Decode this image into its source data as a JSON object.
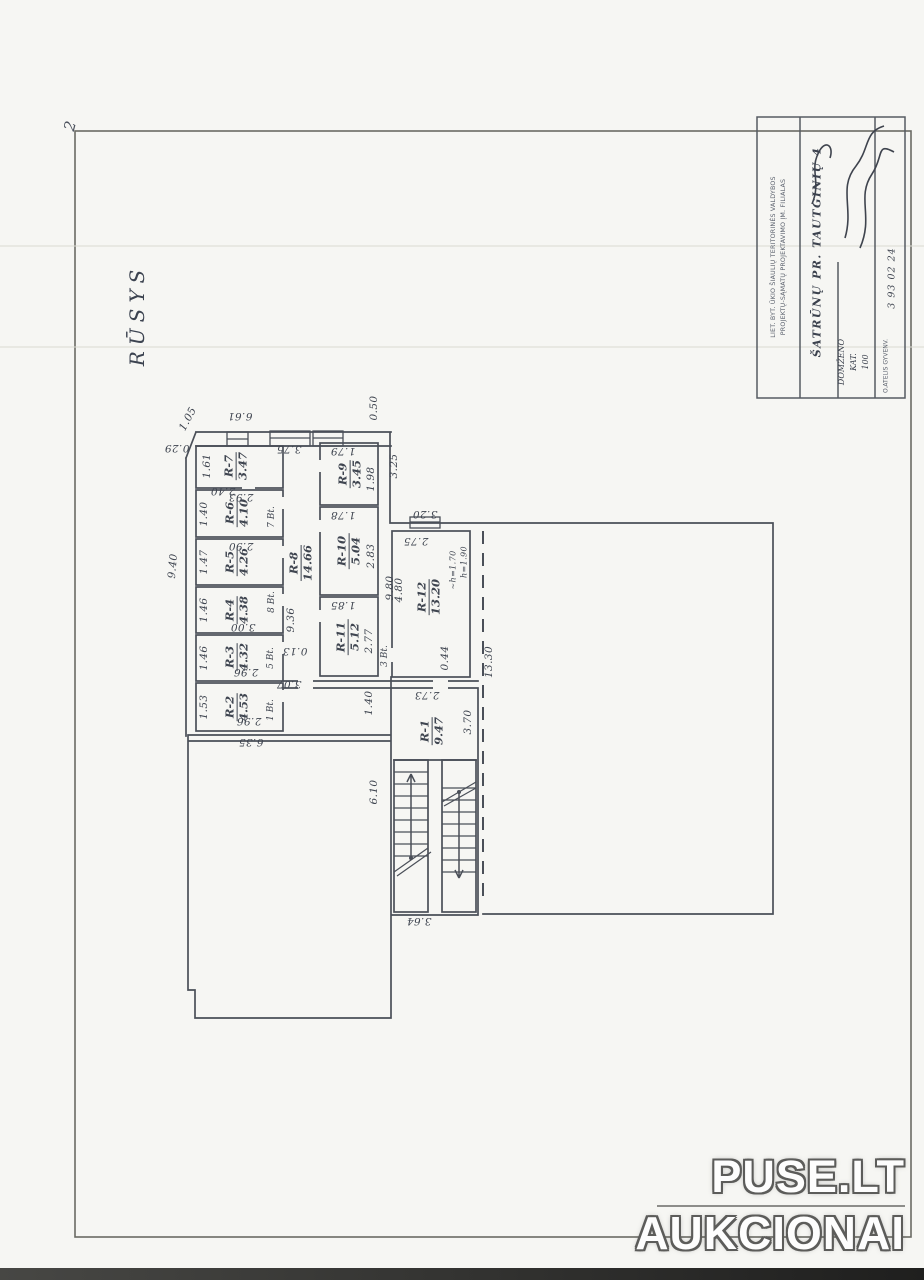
{
  "sheet": {
    "corner_mark": "2"
  },
  "plan": {
    "title": "RŪSYS",
    "rooms": [
      {
        "id": "R-1",
        "area": "9.47",
        "x": 432,
        "y": 731
      },
      {
        "id": "R-2",
        "area": "4.53",
        "x": 237,
        "y": 707
      },
      {
        "id": "R-3",
        "area": "4.32",
        "x": 237,
        "y": 657
      },
      {
        "id": "R-4",
        "area": "4.38",
        "x": 237,
        "y": 610
      },
      {
        "id": "R-5",
        "area": "4.26",
        "x": 237,
        "y": 562
      },
      {
        "id": "R-6",
        "area": "4.10",
        "x": 237,
        "y": 513
      },
      {
        "id": "R-7",
        "area": "3.47",
        "x": 236,
        "y": 466
      },
      {
        "id": "R-8",
        "area": "14.66",
        "x": 301,
        "y": 563
      },
      {
        "id": "R-9",
        "area": "3.45",
        "x": 350,
        "y": 474
      },
      {
        "id": "R-10",
        "area": "5.04",
        "x": 349,
        "y": 551
      },
      {
        "id": "R-11",
        "area": "5.12",
        "x": 348,
        "y": 637
      },
      {
        "id": "R-12",
        "area": "13.20",
        "x": 429,
        "y": 597
      }
    ],
    "dims": [
      {
        "t": "6.61",
        "x": 240,
        "y": 416,
        "r": 180
      },
      {
        "t": "1.05",
        "x": 188,
        "y": 419,
        "r": -62
      },
      {
        "t": "0.29",
        "x": 177,
        "y": 448,
        "r": 180
      },
      {
        "t": "3.75",
        "x": 289,
        "y": 449,
        "r": 180
      },
      {
        "t": "0.50",
        "x": 374,
        "y": 408,
        "r": -90
      },
      {
        "t": "3.25",
        "x": 394,
        "y": 466,
        "r": -90
      },
      {
        "t": "1.61",
        "x": 207,
        "y": 466,
        "r": -90
      },
      {
        "t": "2.40",
        "x": 223,
        "y": 491,
        "r": 180
      },
      {
        "t": "1.40",
        "x": 204,
        "y": 514,
        "r": -90
      },
      {
        "t": "2.93",
        "x": 241,
        "y": 497,
        "r": 180
      },
      {
        "t": "1.47",
        "x": 204,
        "y": 562,
        "r": -90
      },
      {
        "t": "2.90",
        "x": 241,
        "y": 546,
        "r": 180
      },
      {
        "t": "1.46",
        "x": 204,
        "y": 610,
        "r": -90
      },
      {
        "t": "3.00",
        "x": 243,
        "y": 627,
        "r": 180
      },
      {
        "t": "1.46",
        "x": 204,
        "y": 658,
        "r": -90
      },
      {
        "t": "2.96",
        "x": 246,
        "y": 672,
        "r": 180
      },
      {
        "t": "1.53",
        "x": 204,
        "y": 707,
        "r": -90
      },
      {
        "t": "2.96",
        "x": 249,
        "y": 721,
        "r": 180
      },
      {
        "t": "9.40",
        "x": 173,
        "y": 566,
        "r": -85
      },
      {
        "t": "1.79",
        "x": 343,
        "y": 451,
        "r": 180
      },
      {
        "t": "1.98",
        "x": 371,
        "y": 479,
        "r": -90
      },
      {
        "t": "1.78",
        "x": 343,
        "y": 515,
        "r": 180
      },
      {
        "t": "2.83",
        "x": 371,
        "y": 556,
        "r": -90
      },
      {
        "t": "1.85",
        "x": 343,
        "y": 605,
        "r": 180
      },
      {
        "t": "2.77",
        "x": 369,
        "y": 641,
        "r": -90
      },
      {
        "t": "9.36",
        "x": 291,
        "y": 620,
        "r": -90
      },
      {
        "t": "0.13",
        "x": 295,
        "y": 651,
        "r": 180
      },
      {
        "t": "3.07",
        "x": 289,
        "y": 684,
        "r": 180
      },
      {
        "t": "9.80",
        "x": 390,
        "y": 588,
        "r": -90
      },
      {
        "t": "3.20",
        "x": 425,
        "y": 514,
        "r": 180
      },
      {
        "t": "2.75",
        "x": 416,
        "y": 541,
        "r": 180
      },
      {
        "t": "4.80",
        "x": 399,
        "y": 590,
        "r": -90
      },
      {
        "t": "~h=1.70",
        "x": 453,
        "y": 570,
        "r": -90,
        "fs": 8
      },
      {
        "t": "h=1.90",
        "x": 464,
        "y": 562,
        "r": -90,
        "fs": 8
      },
      {
        "t": "0.44",
        "x": 445,
        "y": 658,
        "r": -90
      },
      {
        "t": "13.30",
        "x": 489,
        "y": 662,
        "r": -90
      },
      {
        "t": "2.73",
        "x": 427,
        "y": 695,
        "r": 180
      },
      {
        "t": "1.40",
        "x": 369,
        "y": 703,
        "r": -90
      },
      {
        "t": "3.70",
        "x": 468,
        "y": 722,
        "r": -90
      },
      {
        "t": "6.10",
        "x": 374,
        "y": 792,
        "r": -90
      },
      {
        "t": "6.35",
        "x": 251,
        "y": 742,
        "r": 180
      },
      {
        "t": "3.64",
        "x": 419,
        "y": 921,
        "r": 180
      }
    ],
    "tags": [
      {
        "t": "7 Bt.",
        "x": 272,
        "y": 517
      },
      {
        "t": "8 Bt.",
        "x": 272,
        "y": 602
      },
      {
        "t": "5 Bt.",
        "x": 271,
        "y": 658
      },
      {
        "t": "1 Bt.",
        "x": 271,
        "y": 710
      },
      {
        "t": "3 Bt.",
        "x": 385,
        "y": 656
      }
    ]
  },
  "title_block": {
    "org_line1": "LIET. BYT. ŪKIO ŠIAULIŲ TERITORINĖS VALDYBOS",
    "org_line2": "PROJEKTŲ-SĄMATŲ PROJEKTAVIMO ĮM. FILIALAS",
    "object_name": "ŠATRŪNŲ PR. TAUTGINIŲ 4",
    "doc_lines": [
      "DOMŽENO",
      "KAT.",
      "100"
    ],
    "date_hand": "3  93 02 24",
    "date_printed": "O.ATELIS GYVENV."
  },
  "watermark": {
    "line1": "PUSE.LT",
    "line2": "AUKCIONAI"
  }
}
